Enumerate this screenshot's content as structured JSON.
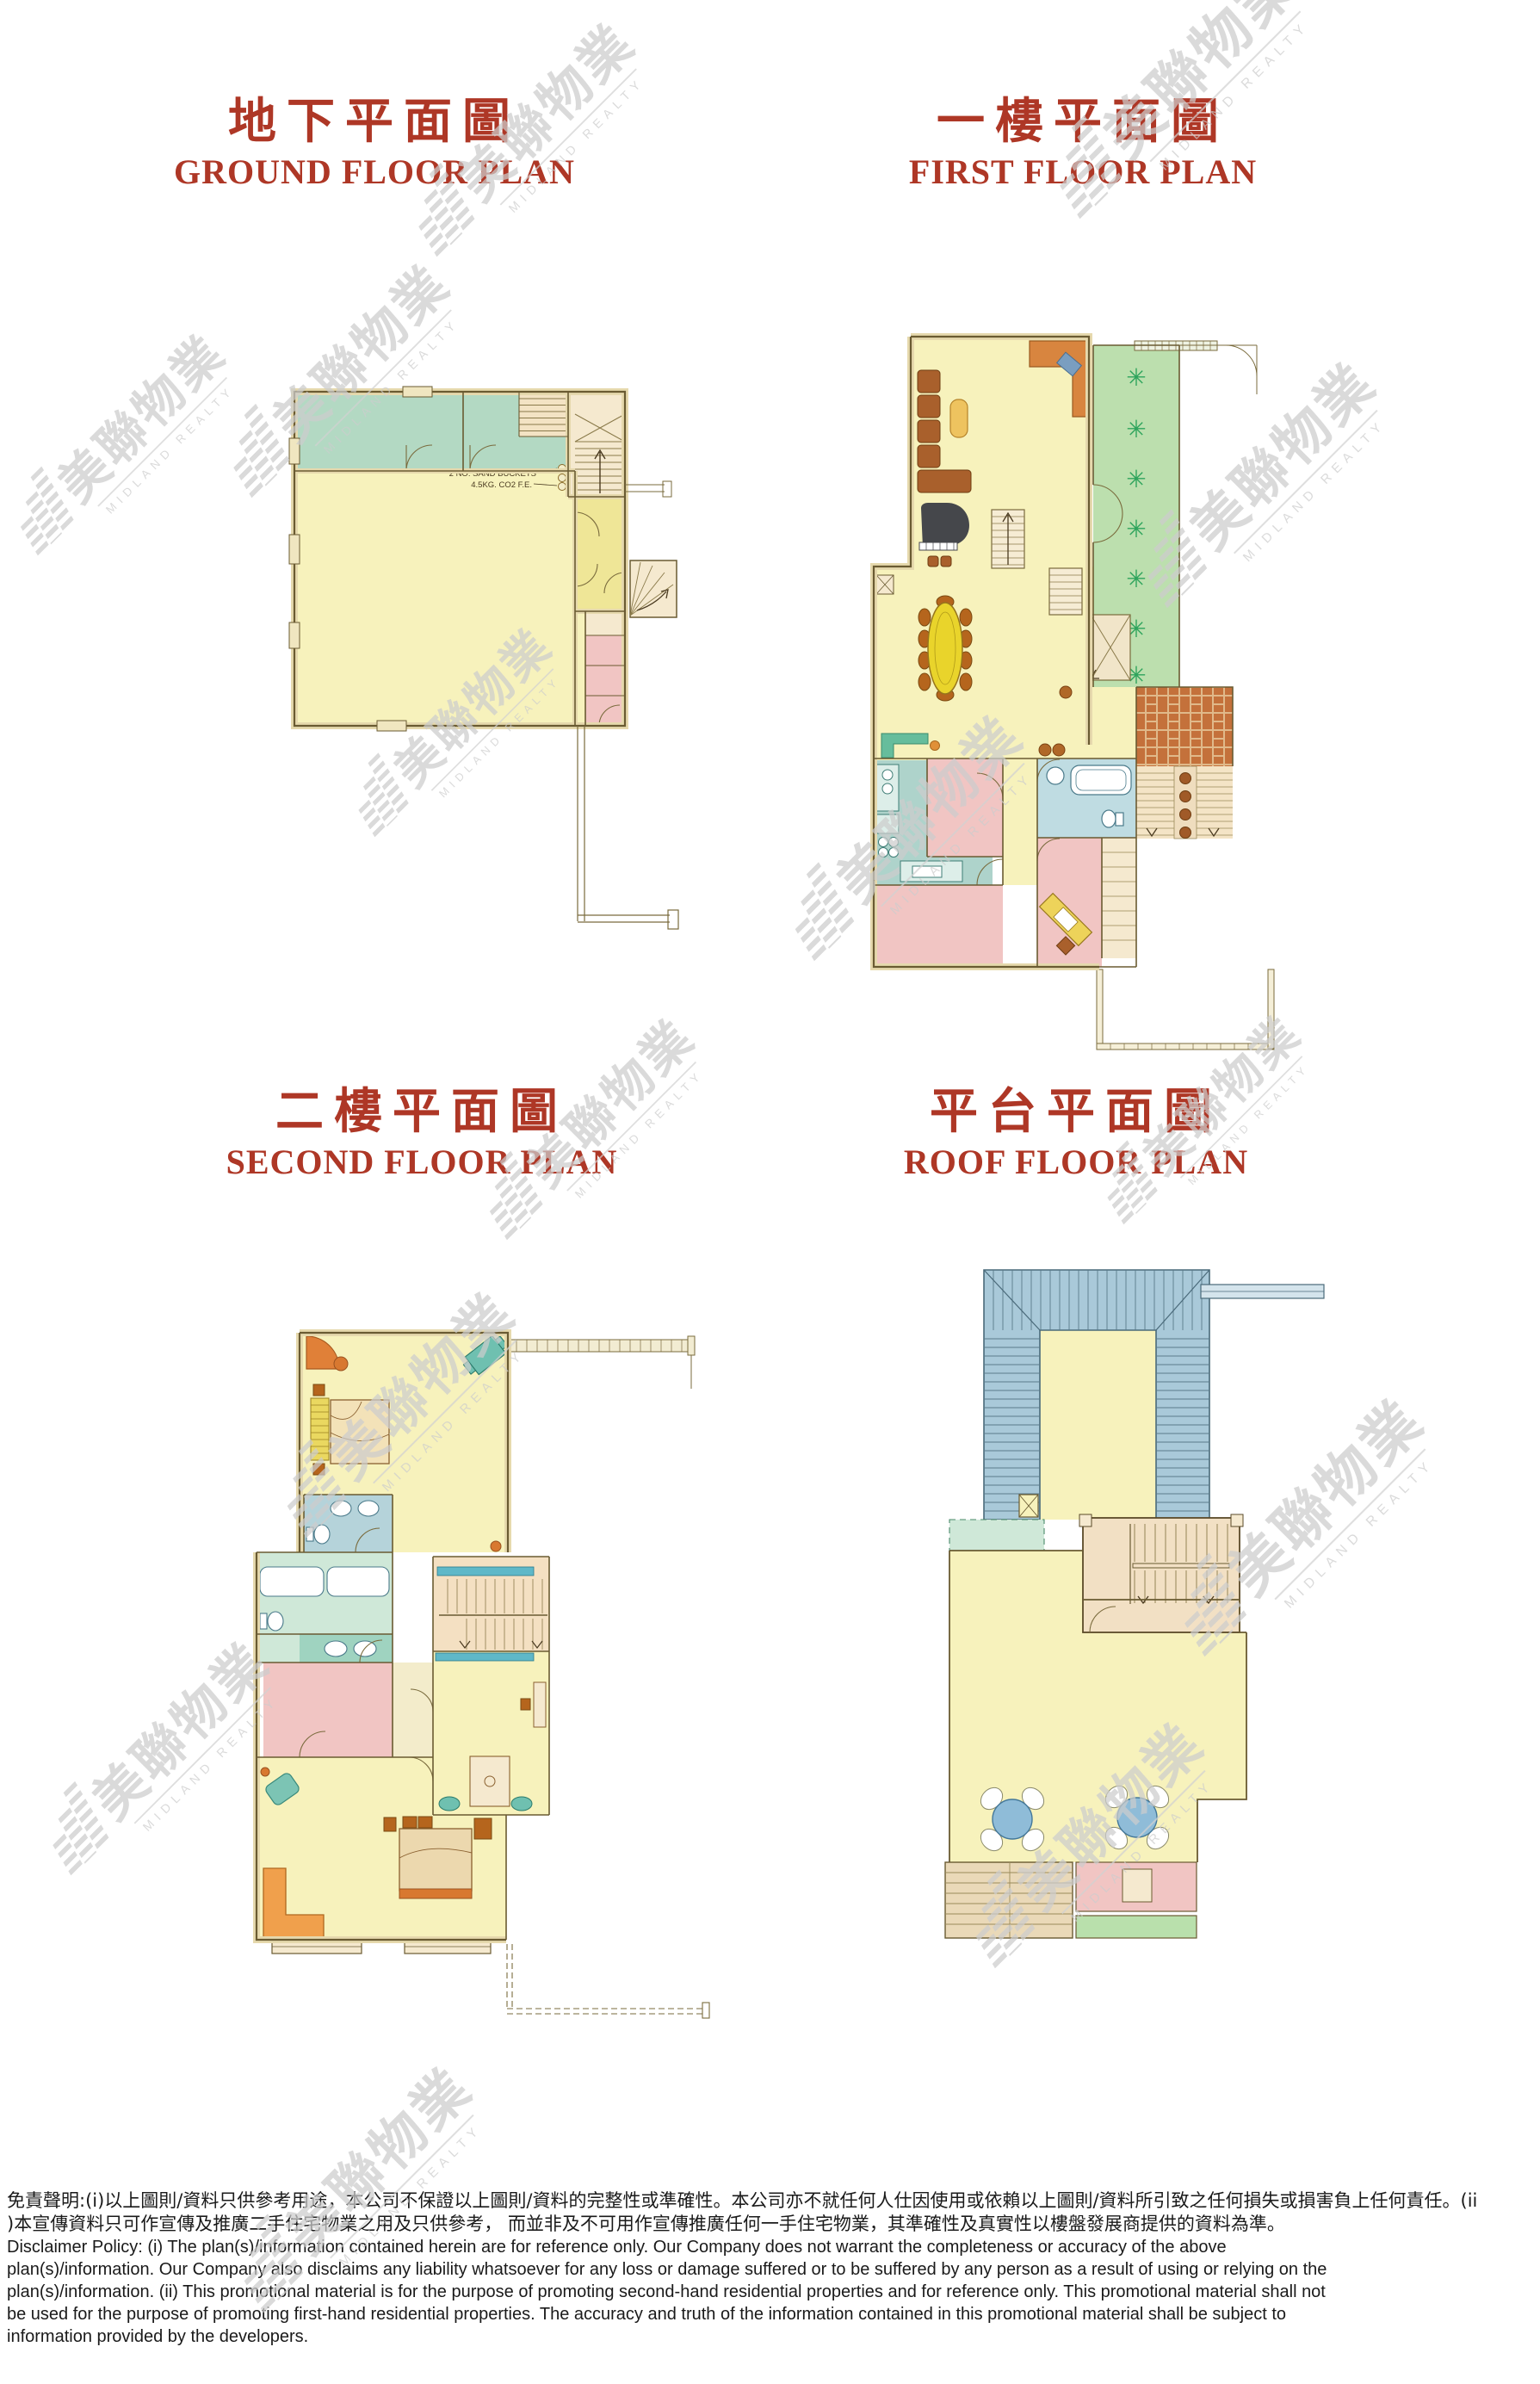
{
  "page": {
    "bg": "#ffffff"
  },
  "titles": [
    {
      "zh": "地下平面圖",
      "en": "GROUND FLOOR PLAN"
    },
    {
      "zh": "一樓平面圖",
      "en": "FIRST FLOOR PLAN"
    },
    {
      "zh": "二樓平面圖",
      "en": "SECOND FLOOR PLAN"
    },
    {
      "zh": "平台平面圖",
      "en": "ROOF FLOOR PLAN"
    }
  ],
  "ground_plan": {
    "annotation_line1": "2 NO. SAND BUCKETS",
    "annotation_line2": "4.5KG. CO2 F.E."
  },
  "watermark": {
    "zh": "美聯物業",
    "en": "MIDLAND REALTY"
  },
  "disclaimer": {
    "zh_lines": [
      "免責聲明:(i)以上圖則/資料只供參考用途，本公司不保證以上圖則/資料的完整性或準確性。本公司亦不就任何人仕因使用或依賴以上圖則/資料所引致之任何損失或損害負上任何責任。(ii",
      ")本宣傳資料只可作宣傳及推廣二手住宅物業之用及只供參考， 而並非及不可用作宣傳推廣任何一手住宅物業，其準確性及真實性以樓盤發展商提供的資料為準。"
    ],
    "en_lines": [
      "Disclaimer Policy: (i) The plan(s)/information contained herein are for reference only. Our Company does not warrant the completeness or accuracy of the above",
      "plan(s)/information. Our Company also disclaims any liability whatsoever for any loss or damage suffered or to be suffered by any person as a result of using or relying on the",
      "plan(s)/information. (ii) This promotional material is for the purpose of promoting second-hand residential properties and for reference only. This promotional material shall not",
      "be used for the purpose of promoting first-hand residential properties. The accuracy and truth of the information contained in this promotional material shall be subject to",
      "information provided by the developers."
    ]
  },
  "colors": {
    "title_red": "#ae3726",
    "wall_line": "#6a5b32",
    "wall_band": "#e6d9ad",
    "floor_yellow": "#f7f2bc",
    "teal_room": "#b3d9c3",
    "pink_room": "#f1c5c3",
    "garden_green": "#bcdfae",
    "roof_blue": "#a9c9d9",
    "stair_cream": "#f3e3c4",
    "brick_orange": "#c4713b",
    "watermark_gray": "#cdcdcd"
  }
}
